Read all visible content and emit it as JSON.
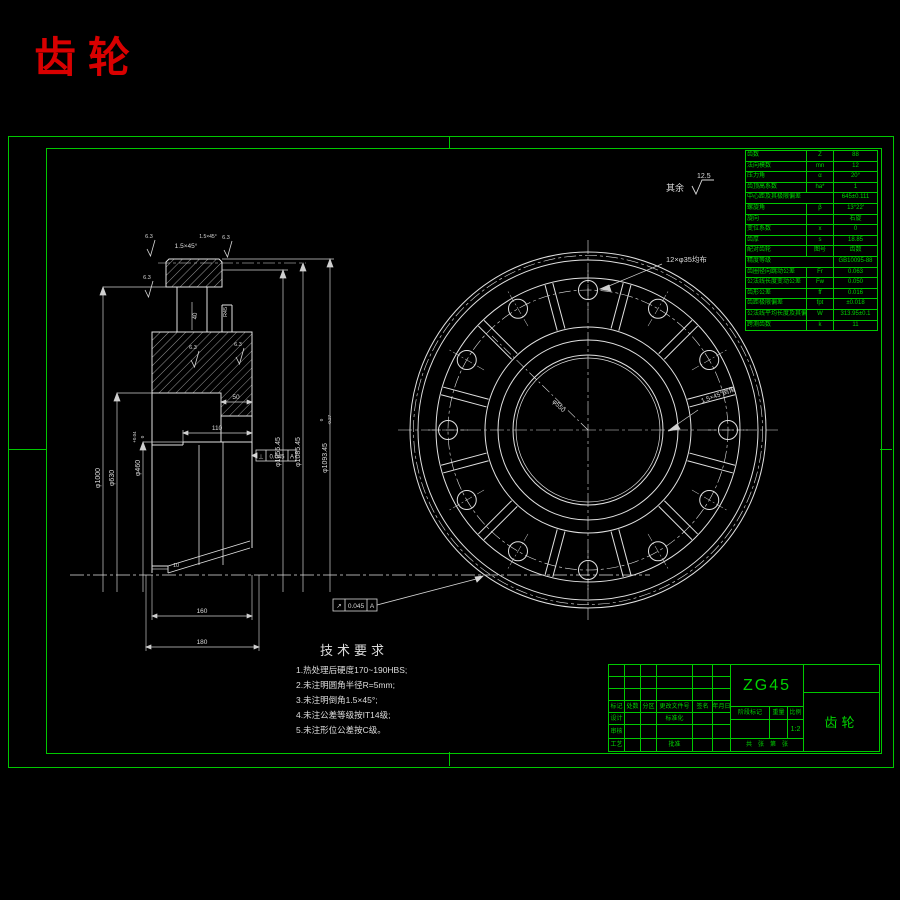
{
  "title": {
    "text": "齿轮"
  },
  "surface_note": {
    "prefix": "其余",
    "value": "12.5"
  },
  "gear_table": {
    "rows": [
      [
        "齿数",
        "Z",
        "88"
      ],
      [
        "法向模数",
        "mn",
        "12"
      ],
      [
        "压力角",
        "α",
        "20°"
      ],
      [
        "齿顶高系数",
        "ha*",
        "1"
      ],
      [
        "中心距及其极限偏差",
        "",
        "645±0.111"
      ],
      [
        "螺旋角",
        "β",
        "13°22′"
      ],
      [
        "旋向",
        "",
        "右旋"
      ],
      [
        "变位系数",
        "x",
        "0"
      ],
      [
        "齿厚",
        "s",
        "18.85"
      ],
      [
        "配对齿轮",
        "图号",
        "齿数"
      ],
      [
        "精度等级",
        "",
        "GB10095-88"
      ],
      [
        "齿圈径向跳动公差",
        "Fr",
        "0.063"
      ],
      [
        "公法线长度变动公差",
        "Fw",
        "0.050"
      ],
      [
        "齿形公差",
        "ff",
        "0.016"
      ],
      [
        "齿距极限偏差",
        "fpt",
        "±0.018"
      ],
      [
        "公法线平均长度及其偏差",
        "W",
        "313.95±0.1"
      ],
      [
        "跨测齿数",
        "k",
        "11"
      ]
    ]
  },
  "annotations": {
    "chamfer1": "1.5×45°",
    "chamfer2": "1.5×45°",
    "dim_40": "40",
    "dim_r45": "R45",
    "dim_50": "50",
    "dim_110": "110",
    "dim_10": "10",
    "dim_160": "160",
    "dim_180": "180",
    "dia_1000": "φ1000",
    "dia_630": "φ630",
    "dia_460": "φ460",
    "dia_460_tol_top": "+0.04",
    "dia_460_tol_bot": "0",
    "dia_1055": "φ1055.45",
    "dia_1085": "φ1085.45",
    "dia_1093": "φ1093.45",
    "dia_1093_tol_top": "0",
    "dia_1093_tol_bot": "-0.27",
    "dia_550": "φ550",
    "holes_note": "12×φ35均布",
    "rim_chamfer_note": "1.5×45°倒角",
    "frame1": {
      "sym": "⊥",
      "val": "0.045",
      "datum": "A"
    },
    "frame2": {
      "sym": "↗",
      "val": "0.045",
      "datum": "A"
    },
    "roughness": [
      "6.3",
      "6.3",
      "6.3",
      "6.3",
      "6.3"
    ]
  },
  "tech_req": {
    "title": "技术要求",
    "lines": [
      "1.热处理后硬度170~190HBS;",
      "2.未注明圆角半径R=5mm;",
      "3.未注明倒角1.5×45°;",
      "4.未注公差等级按IT14级;",
      "5.未注形位公差按C级。"
    ]
  },
  "title_block": {
    "material": "ZG45",
    "part_name": "齿轮",
    "rev_headers": [
      "标记",
      "处数",
      "分区",
      "更改文件号",
      "签名",
      "年月日"
    ],
    "label_design": "设计",
    "label_standard": "标准化",
    "label_audit": "审核",
    "label_process": "工艺",
    "label_approve": "批准",
    "stage_headers": [
      "阶段标记",
      "重量",
      "比例"
    ],
    "scale_value": "1:2",
    "sheet_note": "共　张　第　张"
  }
}
